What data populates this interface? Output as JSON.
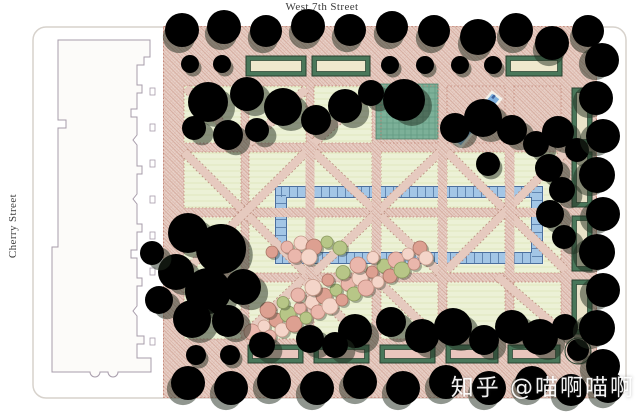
{
  "plan": {
    "top_street_label": "West 7th Street",
    "left_street_label": "Cherry Street",
    "palette": {
      "walkway_pink": "#e8d0c7",
      "path_edge_red": "#b98a7b",
      "lawn_green": "#ecf1d6",
      "basin_teal": "#7cb098",
      "water_blue": "#7fb0dd",
      "water_edge_blue": "#4a6f9e",
      "hedge_green": "#49775a",
      "canopy_dark_green": "#6aa083",
      "canopy_light_green": "#cfdf92",
      "flowering_tree_pink": "#eab7ac",
      "building_outline": "#a79cab"
    }
  },
  "watermark": {
    "text": "知乎 @喵啊喵啊",
    "color": "#ffffff"
  }
}
